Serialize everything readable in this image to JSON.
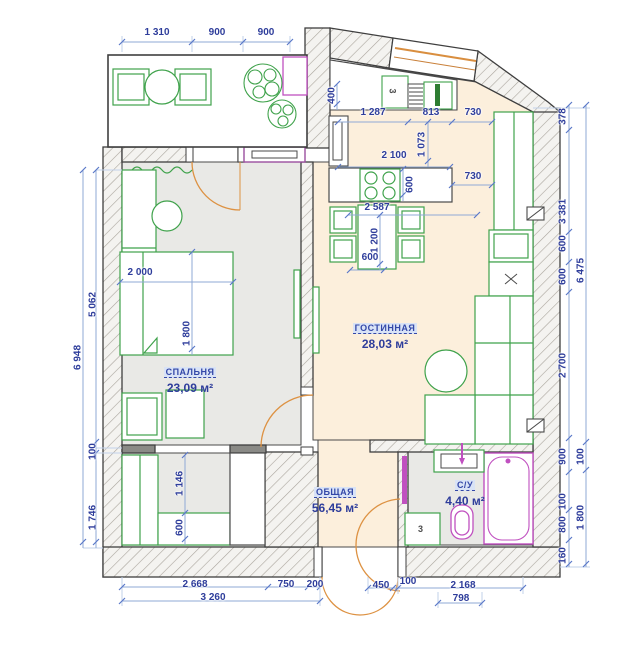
{
  "rooms": {
    "living": {
      "name": "ГОСТИННАЯ",
      "area": "28,03 м²"
    },
    "bedroom": {
      "name": "СПАЛЬНЯ",
      "area": "23,09 м²"
    },
    "total": {
      "name": "ОБЩАЯ",
      "area": "56,45 м²"
    },
    "bathroom": {
      "name": "С/У",
      "area": "4,40 м²"
    }
  },
  "markers": {
    "kitchen_unit": "3",
    "hall_cabinet": "3"
  },
  "dims": {
    "top": [
      "1 310",
      "900",
      "900"
    ],
    "kitchen": {
      "k400": "400",
      "k1287": "1 287",
      "k813": "813",
      "k730a": "730",
      "k1073": "1 073",
      "k2100": "2 100",
      "k600a": "600",
      "k730b": "730",
      "k2587": "2 587",
      "k1200": "1 200",
      "k600b": "600"
    },
    "bedroom": {
      "b2000": "2 000",
      "b1800": "1 800",
      "b1146": "1 146",
      "b600": "600"
    },
    "left": {
      "l6948": "6 948",
      "l5062": "5 062",
      "l100": "100",
      "l1746": "1 746"
    },
    "right": {
      "r378": "378",
      "r3381": "3 381",
      "r600a": "600",
      "r600b": "600",
      "r2700": "2 700",
      "r900": "900",
      "r100a": "100",
      "r800": "800",
      "r160": "160",
      "r6475": "6 475",
      "r100b": "100",
      "r1800": "1 800"
    },
    "bottom": {
      "bt2668": "2 668",
      "bt750": "750",
      "bt200": "200",
      "bt3260": "3 260",
      "bt450": "450",
      "bt100": "100",
      "bt2168": "2 168",
      "bt798": "798"
    }
  },
  "colors": {
    "dim": "#2e3d9b",
    "wall": "#3f3f3f",
    "furniture": "#3fa24b",
    "door": "#dd9243",
    "sanitary": "#c050c0",
    "floor_living": "#fcefdc",
    "floor_gray": "#e9e9e6"
  }
}
